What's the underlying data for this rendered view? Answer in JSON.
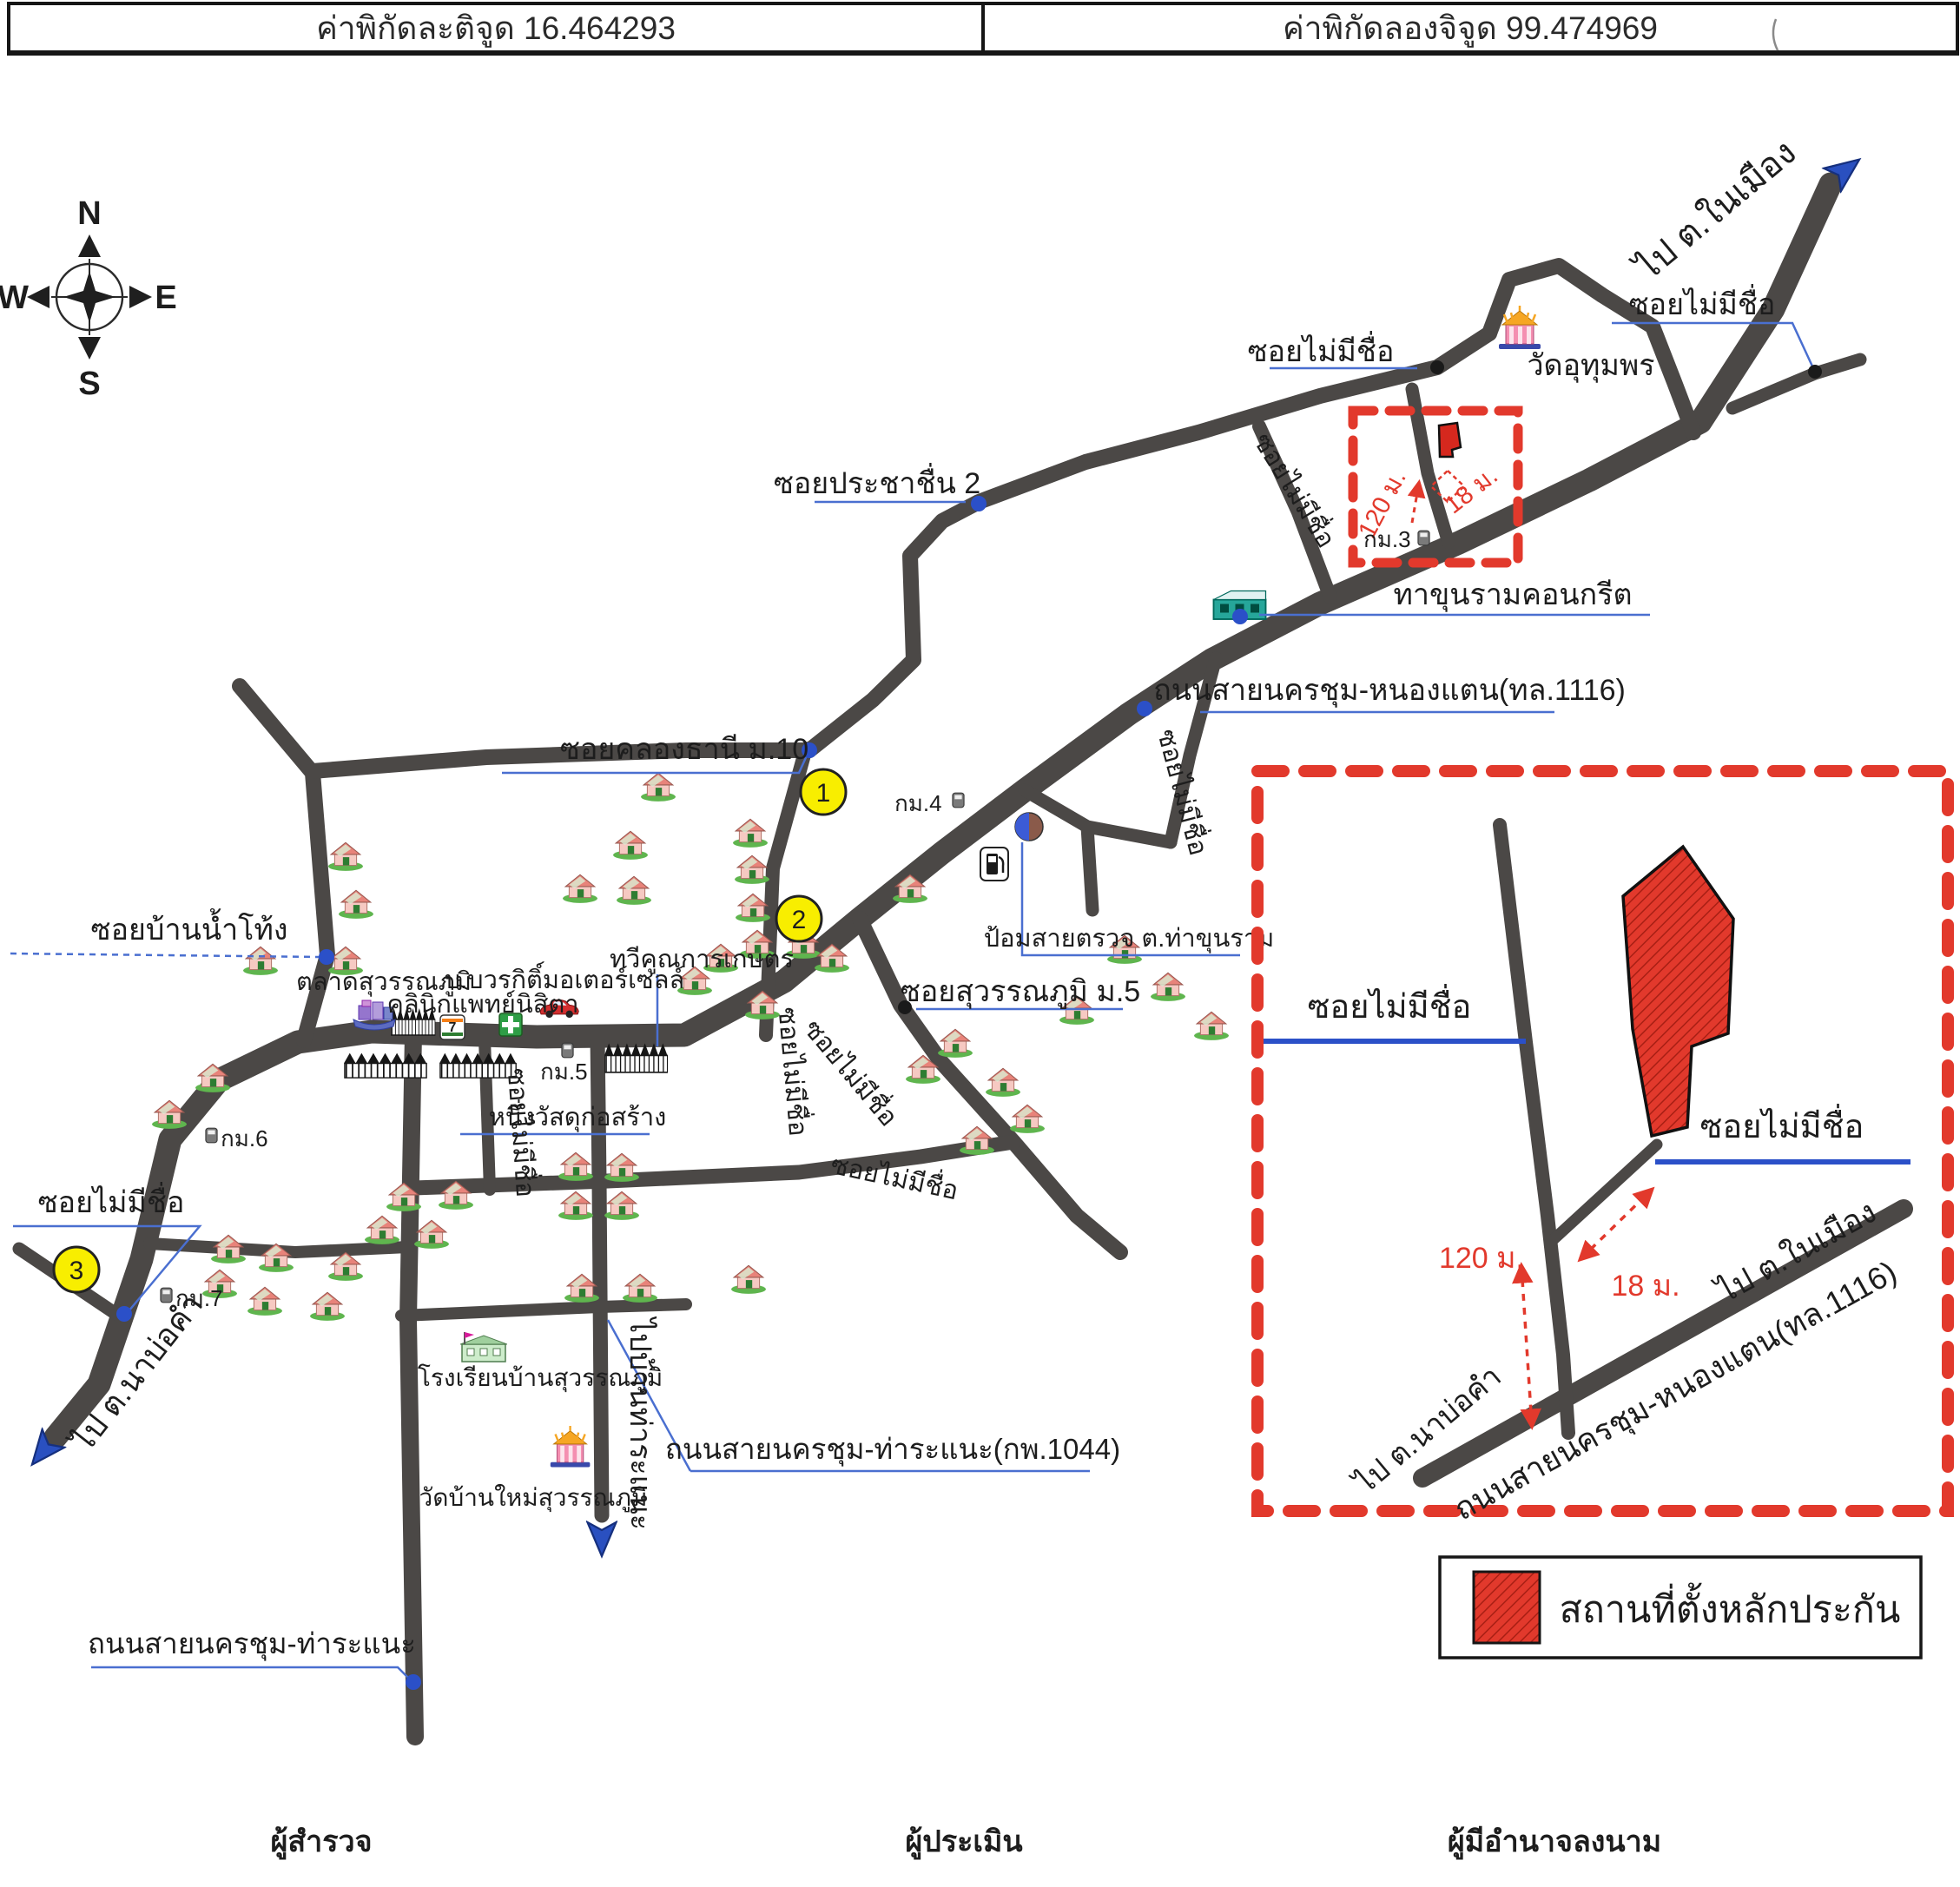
{
  "header": {
    "latitude": "ค่าพิกัดละติจูด 16.464293",
    "longitude": "ค่าพิกัดลองจิจูด 99.474969"
  },
  "compass": {
    "north": "N",
    "south": "S",
    "east": "E",
    "west": "W"
  },
  "labels": {
    "soi_noname": "ซอยไม่มีชื่อ",
    "wat_uthumphon": "วัดอุทุมพร",
    "to_nai_mueang": "ไป ต.ในเมือง",
    "to_na_bo_kham": "ไป ต.นาบ่อคำ",
    "to_ban_tha_ranae": "ไปบ้านท่าระแนะ",
    "soi_prachachuen_2": "ซอยประชาชื่น 2",
    "tha_khun_ram_concrete": "ทาขุนรามคอนกรีต",
    "road_nakhon_chum_nong_taen": "ถนนสายนครชุม-หนองแตน(ทล.1116)",
    "soi_khlong_thani": "ซอยคลองธานี ม.10",
    "soi_ban_nam_thong": "ซอยบ้านน้ำโท้ง",
    "police_box": "ป้อมสายตรวจ ต.ท่าขุนราม",
    "soi_suwannaphum": "ซอยสุวรรณภูมิ ม.5",
    "talat_suwannaphum": "ตลาดสุวรรณภูมิ",
    "bowonkit_motor": "บ.บวรกิติ์มอเตอร์เซลล์",
    "clinic_nisita": "คลินิกแพทย์นิสิตา",
    "thawikhun_kaset": "ทวีคูณการเกษตร",
    "nueng_building_material": "หนึ่งวัสดุก่อสร้าง",
    "school_ban_suwannaphum": "โรงเรียนบ้านสุวรรณภูมิ",
    "wat_ban_mai": "วัดบ้านใหม่สุวรรณภูมิ",
    "road_tha_ranae_1044": "ถนนสายนครชุม-ท่าระแนะ(กพ.1044)",
    "road_tha_ranae": "ถนนสายนครชุม-ท่าระแนะ",
    "km3": "กม.3",
    "km4": "กม.4",
    "km5": "กม.5",
    "km6": "กม.6",
    "km7": "กม.7",
    "marker_1": "1",
    "marker_2": "2",
    "marker_3": "3",
    "dist_120m": "120 ม.",
    "dist_18m": "18 ม."
  },
  "legend": {
    "collateral_site": "สถานที่ตั้งหลักประกัน"
  },
  "signatures": {
    "surveyor": "ผู้สำรวจ",
    "appraiser": "ผู้ประเมิน",
    "authorized_signatory": "ผู้มีอำนาจลงนาม"
  },
  "colors": {
    "road": "#4b4846",
    "collateral_red": "#e2392c",
    "leader_blue": "#4a6fd0",
    "soi_blue": "#2b50c8",
    "marker_yellow": "#f8ee00"
  },
  "houses": [
    [
      758,
      905
    ],
    [
      726,
      972
    ],
    [
      668,
      1022
    ],
    [
      730,
      1024
    ],
    [
      864,
      958
    ],
    [
      866,
      1000
    ],
    [
      867,
      1044
    ],
    [
      872,
      1086
    ],
    [
      830,
      1102
    ],
    [
      925,
      1086
    ],
    [
      958,
      1102
    ],
    [
      1048,
      1022
    ],
    [
      800,
      1128
    ],
    [
      878,
      1156
    ],
    [
      398,
      985
    ],
    [
      410,
      1040
    ],
    [
      300,
      1105
    ],
    [
      398,
      1105
    ],
    [
      245,
      1240
    ],
    [
      195,
      1282
    ],
    [
      1240,
      1162
    ],
    [
      1295,
      1092
    ],
    [
      1345,
      1135
    ],
    [
      1395,
      1180
    ],
    [
      465,
      1377
    ],
    [
      525,
      1375
    ],
    [
      663,
      1342
    ],
    [
      716,
      1343
    ],
    [
      663,
      1387
    ],
    [
      716,
      1387
    ],
    [
      1100,
      1200
    ],
    [
      1155,
      1245
    ],
    [
      1183,
      1287
    ],
    [
      1125,
      1312
    ],
    [
      1063,
      1230
    ],
    [
      263,
      1437
    ],
    [
      318,
      1447
    ],
    [
      398,
      1457
    ],
    [
      253,
      1477
    ],
    [
      305,
      1497
    ],
    [
      377,
      1503
    ],
    [
      440,
      1415
    ],
    [
      497,
      1420
    ],
    [
      670,
      1482
    ],
    [
      737,
      1482
    ],
    [
      862,
      1472
    ]
  ]
}
